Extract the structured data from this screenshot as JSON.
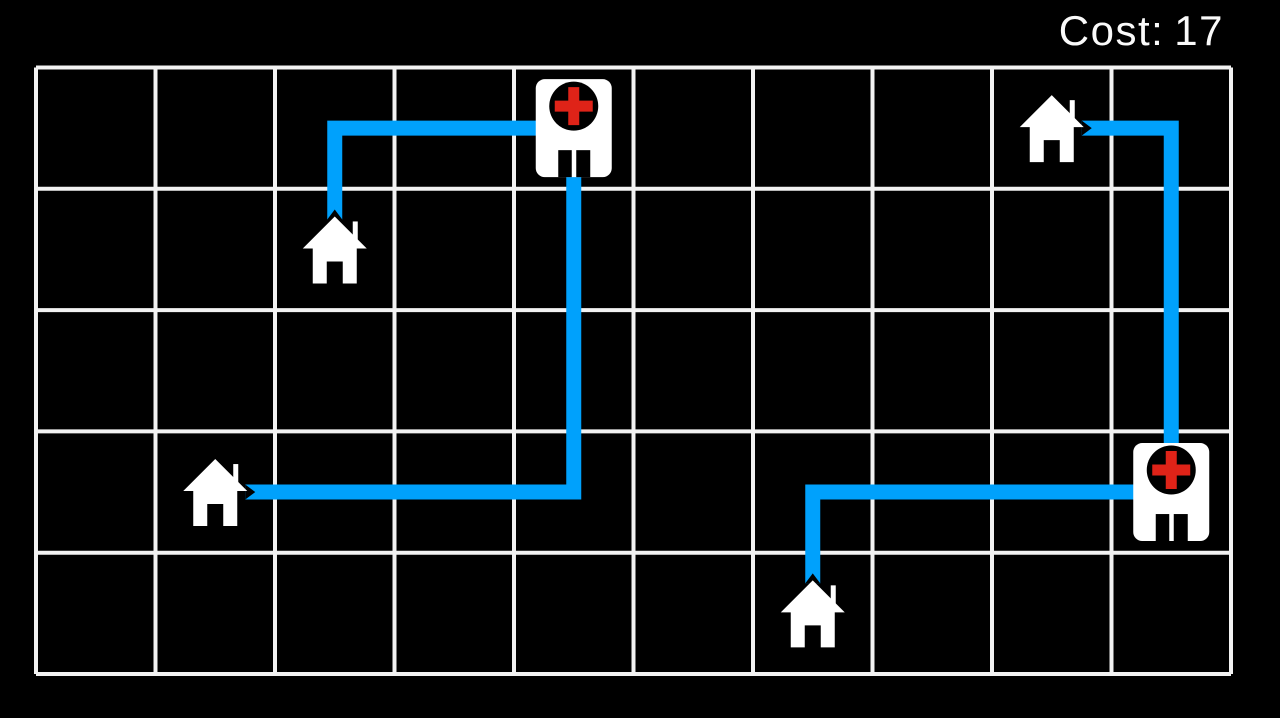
{
  "hud": {
    "cost_label": "Cost:",
    "cost_value": "17"
  },
  "colors": {
    "background": "#000000",
    "grid_line": "#f2f2f2",
    "path_blue": "#00a1fc",
    "building_white": "#ffffff",
    "icon_black": "#000000",
    "cross_red": "#df2318",
    "text_white": "#fafafa"
  },
  "grid": {
    "cols": 10,
    "rows": 5
  },
  "entities": [
    {
      "type": "hospital",
      "name": "hospital-top-middle",
      "col": 4,
      "row": 0
    },
    {
      "type": "hospital",
      "name": "hospital-right",
      "col": 9,
      "row": 3
    },
    {
      "type": "house",
      "name": "house-upper-left",
      "col": 2,
      "row": 1
    },
    {
      "type": "house",
      "name": "house-middle-left",
      "col": 1,
      "row": 3
    },
    {
      "type": "house",
      "name": "house-bottom-middle",
      "col": 6,
      "row": 4
    },
    {
      "type": "house",
      "name": "house-top-right",
      "col": 8,
      "row": 0
    }
  ],
  "routes": [
    {
      "name": "route-hospital-top-to-house-upper-left",
      "length": 3,
      "cells": [
        [
          4,
          0
        ],
        [
          2,
          0
        ],
        [
          2,
          1
        ]
      ]
    },
    {
      "name": "route-hospital-top-to-house-middle-left",
      "length": 6,
      "cells": [
        [
          4,
          0
        ],
        [
          4,
          3
        ],
        [
          1,
          3
        ]
      ]
    },
    {
      "name": "route-hospital-right-to-house-bottom-middle",
      "length": 4,
      "cells": [
        [
          9,
          3
        ],
        [
          6,
          3
        ],
        [
          6,
          4
        ]
      ]
    },
    {
      "name": "route-hospital-right-to-house-top-right",
      "length": 4,
      "cells": [
        [
          9,
          3
        ],
        [
          9,
          0
        ],
        [
          8,
          0
        ]
      ]
    }
  ]
}
